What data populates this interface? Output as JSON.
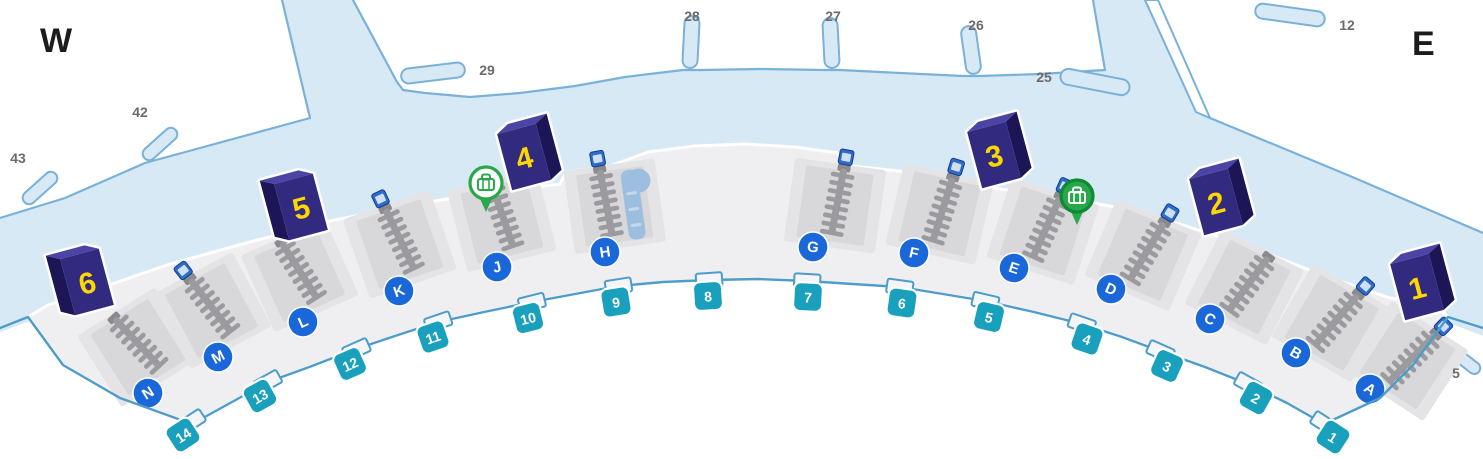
{
  "map": {
    "title": "terminal-baggage-claim-level-map",
    "compass": {
      "west": "W",
      "east": "E"
    },
    "colors": {
      "background": "#ffffff",
      "apron": "#d7e9f5",
      "outline": "#7ab1d9",
      "band": "#efeff1",
      "band_edge": "#4d9cc9",
      "bay": "#e4e4e7",
      "bay_panel": "#d8d8db",
      "belt": "#9b9b9f",
      "belt_dark": "#8a8a8e",
      "belt_square": "#2e6bcc",
      "slide": "#9dbede",
      "slide_stripe": "#c3d8ec",
      "door_teal": "#18a0bd",
      "carousel_blue": "#1967d8",
      "entrance_front": "#312a7e",
      "entrance_side": "#1c1657",
      "entrance_top": "#4b44a5",
      "entrance_number": "#ffd700",
      "pin_green": "#28a84b",
      "pin_green_dark": "#0e8a35",
      "gate_text": "#6b6b6b",
      "jog_fill": "#f4f5f7"
    },
    "gate_labels": [
      {
        "label": "43",
        "x": 18,
        "y": 158
      },
      {
        "label": "42",
        "x": 140,
        "y": 112
      },
      {
        "label": "29",
        "x": 487,
        "y": 70
      },
      {
        "label": "28",
        "x": 692,
        "y": 16
      },
      {
        "label": "27",
        "x": 833,
        "y": 16
      },
      {
        "label": "26",
        "x": 976,
        "y": 25
      },
      {
        "label": "25",
        "x": 1044,
        "y": 77
      },
      {
        "label": "12",
        "x": 1347,
        "y": 25
      },
      {
        "label": "5",
        "x": 1456,
        "y": 373
      }
    ],
    "gate_stubs": [
      {
        "id": "43",
        "cx": 40,
        "cy": 188,
        "w": 42,
        "h": 13,
        "rot": -42
      },
      {
        "id": "42",
        "cx": 160,
        "cy": 144,
        "w": 42,
        "h": 13,
        "rot": -42
      },
      {
        "id": "29",
        "cx": 433,
        "cy": 73,
        "w": 64,
        "h": 15,
        "rot": -7
      },
      {
        "id": "28",
        "cx": 691,
        "cy": 42,
        "w": 15,
        "h": 52,
        "rot": 3
      },
      {
        "id": "27",
        "cx": 831,
        "cy": 43,
        "w": 15,
        "h": 50,
        "rot": -3
      },
      {
        "id": "26",
        "cx": 971,
        "cy": 50,
        "w": 15,
        "h": 48,
        "rot": -8
      },
      {
        "id": "25",
        "cx": 1095,
        "cy": 82,
        "w": 70,
        "h": 16,
        "rot": 11
      },
      {
        "id": "12",
        "cx": 1290,
        "cy": 15,
        "w": 70,
        "h": 15,
        "rot": 8
      },
      {
        "id": "5",
        "cx": 1464,
        "cy": 360,
        "w": 38,
        "h": 12,
        "rot": 38
      }
    ],
    "entrances": [
      {
        "label": "6",
        "x": 87,
        "y": 282,
        "flip": true
      },
      {
        "label": "5",
        "x": 301,
        "y": 207,
        "flip": true
      },
      {
        "label": "4",
        "x": 524,
        "y": 157,
        "flip": false
      },
      {
        "label": "3",
        "x": 994,
        "y": 155,
        "flip": false
      },
      {
        "label": "2",
        "x": 1216,
        "y": 202,
        "flip": false
      },
      {
        "label": "1",
        "x": 1417,
        "y": 287,
        "flip": false
      }
    ],
    "doors": [
      {
        "label": "14",
        "x": 183,
        "y": 435,
        "rot": -33
      },
      {
        "label": "13",
        "x": 260,
        "y": 396,
        "rot": -29
      },
      {
        "label": "12",
        "x": 350,
        "y": 364,
        "rot": -24
      },
      {
        "label": "11",
        "x": 433,
        "y": 337,
        "rot": -19
      },
      {
        "label": "10",
        "x": 528,
        "y": 318,
        "rot": -14
      },
      {
        "label": "9",
        "x": 616,
        "y": 302,
        "rot": -9
      },
      {
        "label": "8",
        "x": 708,
        "y": 296,
        "rot": -4
      },
      {
        "label": "7",
        "x": 808,
        "y": 297,
        "rot": 3
      },
      {
        "label": "6",
        "x": 902,
        "y": 303,
        "rot": 8
      },
      {
        "label": "5",
        "x": 989,
        "y": 317,
        "rot": 13
      },
      {
        "label": "4",
        "x": 1087,
        "y": 339,
        "rot": 19
      },
      {
        "label": "3",
        "x": 1167,
        "y": 366,
        "rot": 24
      },
      {
        "label": "2",
        "x": 1256,
        "y": 398,
        "rot": 29
      },
      {
        "label": "1",
        "x": 1333,
        "y": 437,
        "rot": 33
      }
    ],
    "carousels": [
      {
        "label": "N",
        "x": 148,
        "y": 393,
        "rot": -32,
        "belt_square": false,
        "slide": false
      },
      {
        "label": "M",
        "x": 218,
        "y": 357,
        "rot": -28,
        "belt_square": true,
        "slide": false
      },
      {
        "label": "L",
        "x": 303,
        "y": 322,
        "rot": -24,
        "belt_square": false,
        "slide": false
      },
      {
        "label": "K",
        "x": 399,
        "y": 291,
        "rot": -19,
        "belt_square": true,
        "slide": false
      },
      {
        "label": "J",
        "x": 497,
        "y": 267,
        "rot": -14,
        "belt_square": false,
        "slide": false
      },
      {
        "label": "H",
        "x": 605,
        "y": 252,
        "rot": -8,
        "belt_square": true,
        "slide": true
      },
      {
        "label": "G",
        "x": 813,
        "y": 247,
        "rot": 8,
        "belt_square": true,
        "slide": false
      },
      {
        "label": "F",
        "x": 914,
        "y": 253,
        "rot": 13,
        "belt_square": true,
        "slide": false
      },
      {
        "label": "E",
        "x": 1014,
        "y": 268,
        "rot": 18,
        "belt_square": true,
        "slide": false
      },
      {
        "label": "D",
        "x": 1111,
        "y": 289,
        "rot": 23,
        "belt_square": true,
        "slide": false
      },
      {
        "label": "C",
        "x": 1210,
        "y": 319,
        "rot": 27,
        "belt_square": false,
        "slide": false
      },
      {
        "label": "B",
        "x": 1296,
        "y": 353,
        "rot": 30,
        "belt_square": true,
        "slide": false
      },
      {
        "label": "A",
        "x": 1370,
        "y": 389,
        "rot": 33,
        "belt_square": true,
        "slide": false
      }
    ],
    "baggage_claim_pins": [
      {
        "x": 486,
        "y": 183,
        "style": "outline"
      },
      {
        "x": 1077,
        "y": 196,
        "style": "solid"
      }
    ]
  }
}
